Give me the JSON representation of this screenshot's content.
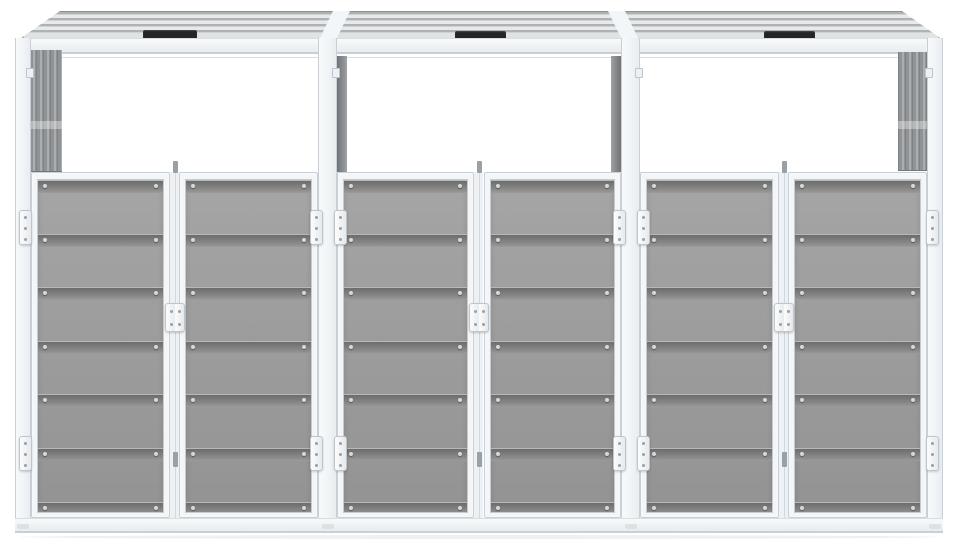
{
  "image": {
    "alt": "Light grey and white steel triple wheelie bin storage shed with three sloped lids, lid hand slots and six louvred doors",
    "background": "#ffffff"
  },
  "shed": {
    "units": 3,
    "doors_per_unit": 2,
    "slats_per_door": 7,
    "lid_slots": 3,
    "hinge_rows": 2,
    "latches": 3
  },
  "colors": {
    "frame_white": "#f3f6f8",
    "frame_white_deep": "#e9edf0",
    "frame_edge": "#c9cfd4",
    "frame_line": "#d8dde0",
    "roof_stripe_light": "#e7e9ea",
    "roof_stripe_mid": "#cfd3d4",
    "roof_stripe_dark": "#aeb2b4",
    "roof_bottom_band": "#e0e3e4",
    "roof_edge_dark": "#8d9193",
    "slot_black": "#232527",
    "slat_grey": "#9b9b9b",
    "slat_shadow": "#6c6c6c",
    "slat_highlight": "#b8b8b8",
    "side_panel_base": "#8f9395",
    "side_panel_dark": "#7e8284",
    "side_panel_light": "#aaaeb0",
    "sliver_grey": "#8a8e90",
    "rivet_light": "#d6d8d9",
    "hardware_white": "#fbfcfd",
    "hardware_border": "#bfc6cb",
    "bolt_grey": "#9aa0a4",
    "gap_line": "#d3d8db",
    "ground_shadow": "#eef1f3"
  }
}
